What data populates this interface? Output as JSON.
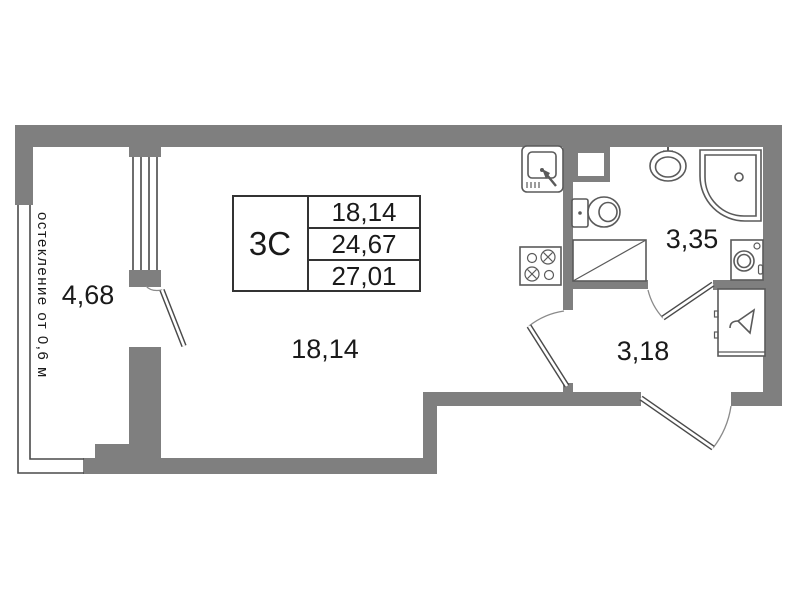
{
  "plan": {
    "info_box": {
      "unit": "3С",
      "rows": [
        "18,14",
        "24,67",
        "27,01"
      ]
    },
    "rooms": {
      "balcony": {
        "label": "4,68"
      },
      "main_room": {
        "label": "18,14"
      },
      "bathroom": {
        "label": "3,35"
      },
      "hallway": {
        "label": "3,18"
      }
    },
    "glazing_note": "остекление от 0,6 м",
    "fixture_icons": [
      "kitchen-sink-icon",
      "stove-icon",
      "vent-shaft-icon",
      "toilet-icon",
      "washbasin-icon",
      "corner-bath-icon",
      "washing-machine-icon",
      "cabinet-icon",
      "wardrobe-icon",
      "door-swing-icon",
      "window-glazing-icon"
    ],
    "colors": {
      "wall": "#7f7f7f",
      "line": "#4a4a4a",
      "fixture": "#5a5a5a",
      "text": "#1a1a1a",
      "table_border": "#333333",
      "background": "#ffffff"
    }
  }
}
